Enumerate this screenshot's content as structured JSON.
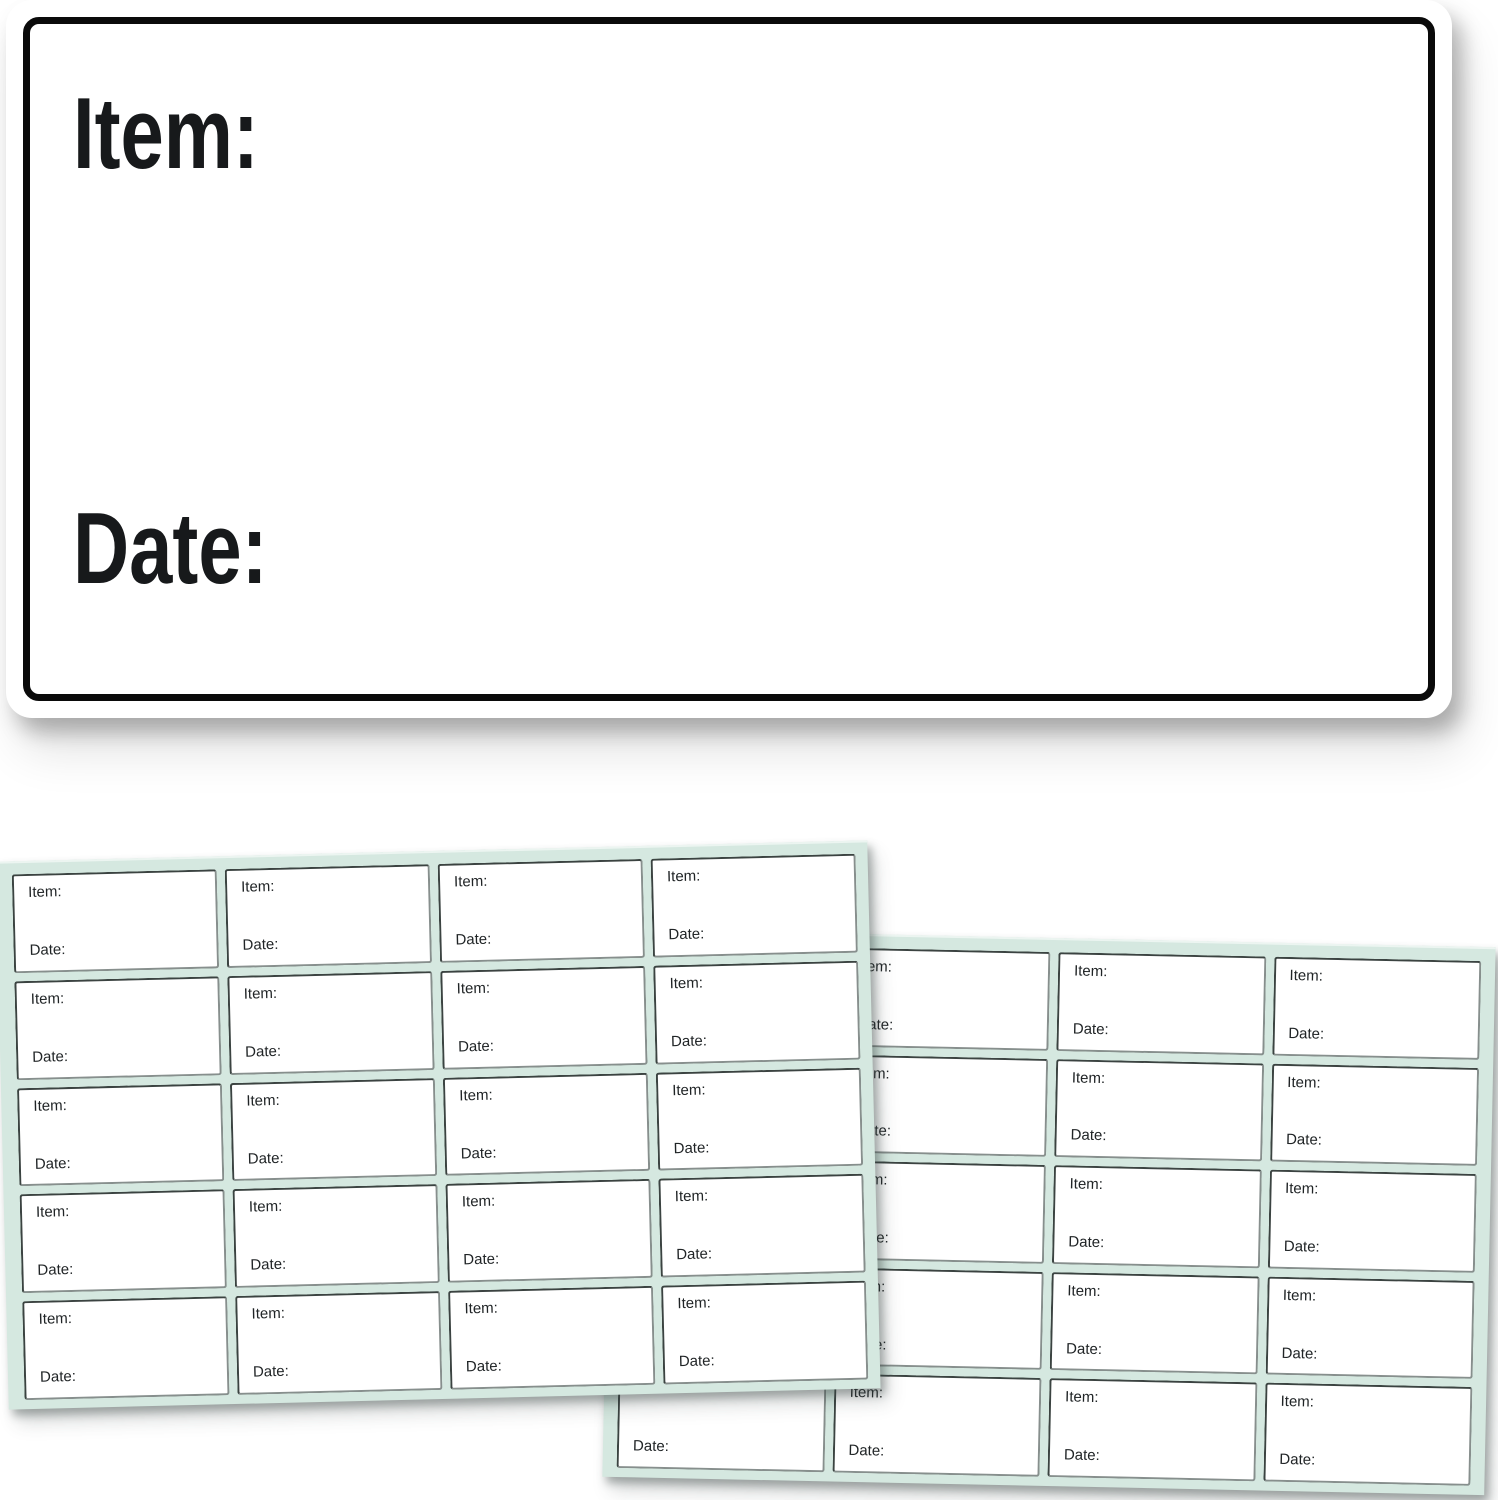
{
  "product_image": {
    "big_label": {
      "item_label": "Item:",
      "date_label": "Date:"
    },
    "sheets": {
      "left": {
        "rows": 5,
        "cols": 4,
        "cell_item_label": "Item:",
        "cell_date_label": "Date:"
      },
      "right": {
        "rows": 5,
        "cols": 4,
        "cell_item_label": "Item:",
        "cell_date_label": "Date:"
      }
    },
    "colors": {
      "sheet_background": "#d5e8e0",
      "cell_border_dark": "#3b4341",
      "cell_border_light": "#878f8d",
      "big_label_border": "#0a0a0a",
      "text_color": "#17191b"
    }
  }
}
